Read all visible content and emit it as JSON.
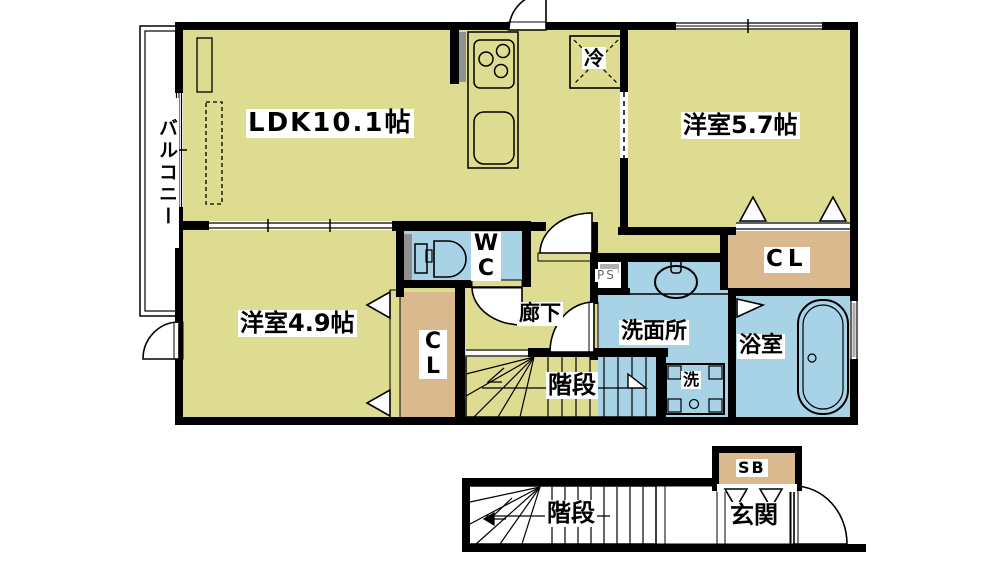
{
  "labels": {
    "balcony": "バルコニー",
    "ldk": "LDK10.1帖",
    "western_room_57": "洋室5.7帖",
    "western_room_49": "洋室4.9帖",
    "refrigerator": "冷",
    "wc": "WC",
    "closet_left": "CL",
    "closet_right": "CL",
    "hallway": "廊下",
    "washroom": "洗面所",
    "bathroom": "浴室",
    "washer": "洗",
    "pipe_space": "PS",
    "stairs_upper": "階段",
    "stairs_lower": "階段",
    "entrance": "玄関",
    "shoe_box": "SB"
  },
  "colors": {
    "room_yellow": "#dedc90",
    "water_blue": "#a8d2e6",
    "kitchen_purple": "#c9a5dc",
    "closet_tan": "#d9b98d",
    "stairs_pink": "#e9a0a0",
    "balcony_gray": "#c9c9c9",
    "entrance_gray": "#bfbfbf",
    "wall": "#000000"
  }
}
